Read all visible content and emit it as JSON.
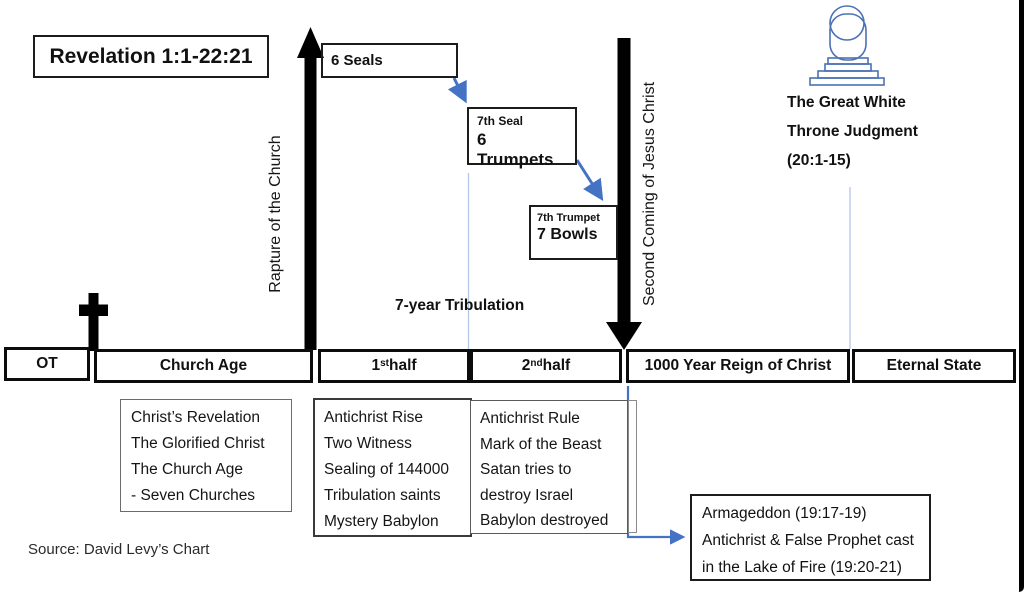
{
  "title": "Revelation 1:1-22:21",
  "source": "Source: David Levy’s Chart",
  "rapture_label": "Rapture of the Church",
  "second_coming_label": "Second Coming of Jesus Christ",
  "tribulation_label": "7-year Tribulation",
  "seals_flow": {
    "seals": "6 Seals",
    "seal7_line1": "7th Seal",
    "seal7_line2": "6 Trumpets",
    "trumpet7_line1": "7th Trumpet",
    "trumpet7_line2": "7 Bowls"
  },
  "throne": {
    "line1": "The Great White",
    "line2": "Throne Judgment",
    "line3": "(20:1-15)"
  },
  "timeline": {
    "segments": [
      {
        "pre": "OT",
        "sup": "",
        "post": ""
      },
      {
        "pre": "Church Age",
        "sup": "",
        "post": ""
      },
      {
        "pre": "1",
        "sup": "st",
        "post": " half"
      },
      {
        "pre": "2",
        "sup": "nd",
        "post": " half"
      },
      {
        "pre": "1000 Year Reign of Christ",
        "sup": "",
        "post": ""
      },
      {
        "pre": "Eternal State",
        "sup": "",
        "post": ""
      }
    ]
  },
  "detail_boxes": {
    "church_age": {
      "lines": [
        "Christ’s Revelation",
        "The Glorified Christ",
        "The Church Age",
        " - Seven Churches"
      ]
    },
    "first_half": {
      "lines": [
        "Antichrist Rise",
        "Two Witness",
        "Sealing of 144000",
        "Tribulation saints",
        "Mystery Babylon"
      ]
    },
    "second_half": {
      "lines": [
        "Antichrist Rule",
        "Mark of the Beast",
        "Satan tries to",
        "destroy Israel",
        "Babylon destroyed"
      ]
    },
    "armageddon": {
      "lines": [
        "Armageddon (19:17-19)",
        "Antichrist & False Prophet cast",
        "in the Lake of Fire (19:20-21)"
      ]
    }
  },
  "colors": {
    "accent_blue": "#4472C4",
    "light_blue": "#b4c7e7",
    "throne_blue": "#4a72b4",
    "black": "#000000"
  }
}
